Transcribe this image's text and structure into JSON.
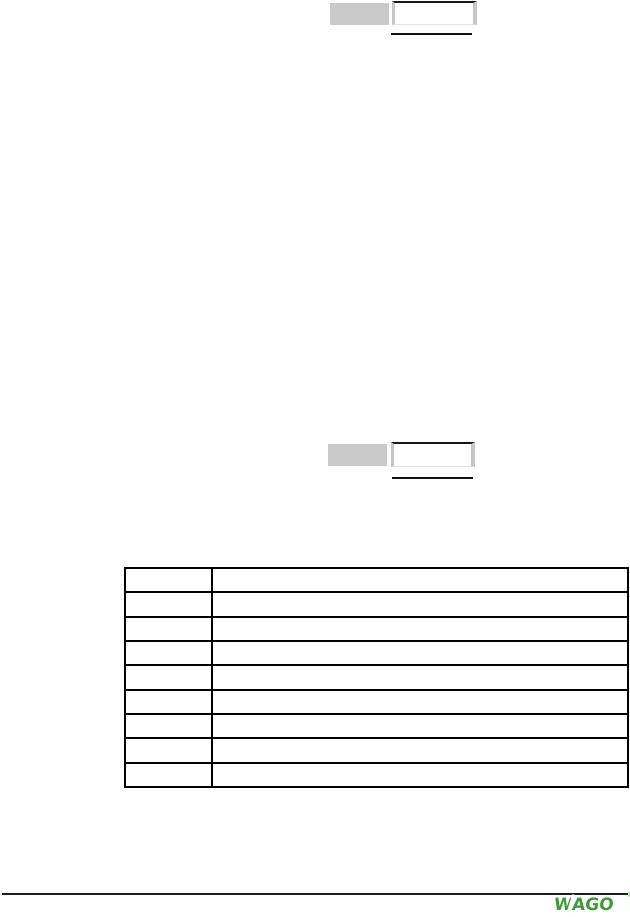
{
  "colors": {
    "page_background": "#ffffff",
    "field_fill_gray": "#cacaca",
    "field_border_gray": "#c6c6c6",
    "line_black": "#111111",
    "table_border": "#000000",
    "wago_green": "#3f9c35"
  },
  "top_field": {
    "label_value": "",
    "entry_value": ""
  },
  "mid_field": {
    "label_value": "",
    "entry_value": ""
  },
  "table": {
    "rows": [
      [
        "",
        ""
      ],
      [
        "",
        ""
      ],
      [
        "",
        ""
      ],
      [
        "",
        ""
      ],
      [
        "",
        ""
      ],
      [
        "",
        ""
      ],
      [
        "",
        ""
      ],
      [
        "",
        ""
      ],
      [
        "",
        ""
      ]
    ]
  },
  "footer": {
    "logo_text": "WAGO",
    "trademark": "®"
  }
}
